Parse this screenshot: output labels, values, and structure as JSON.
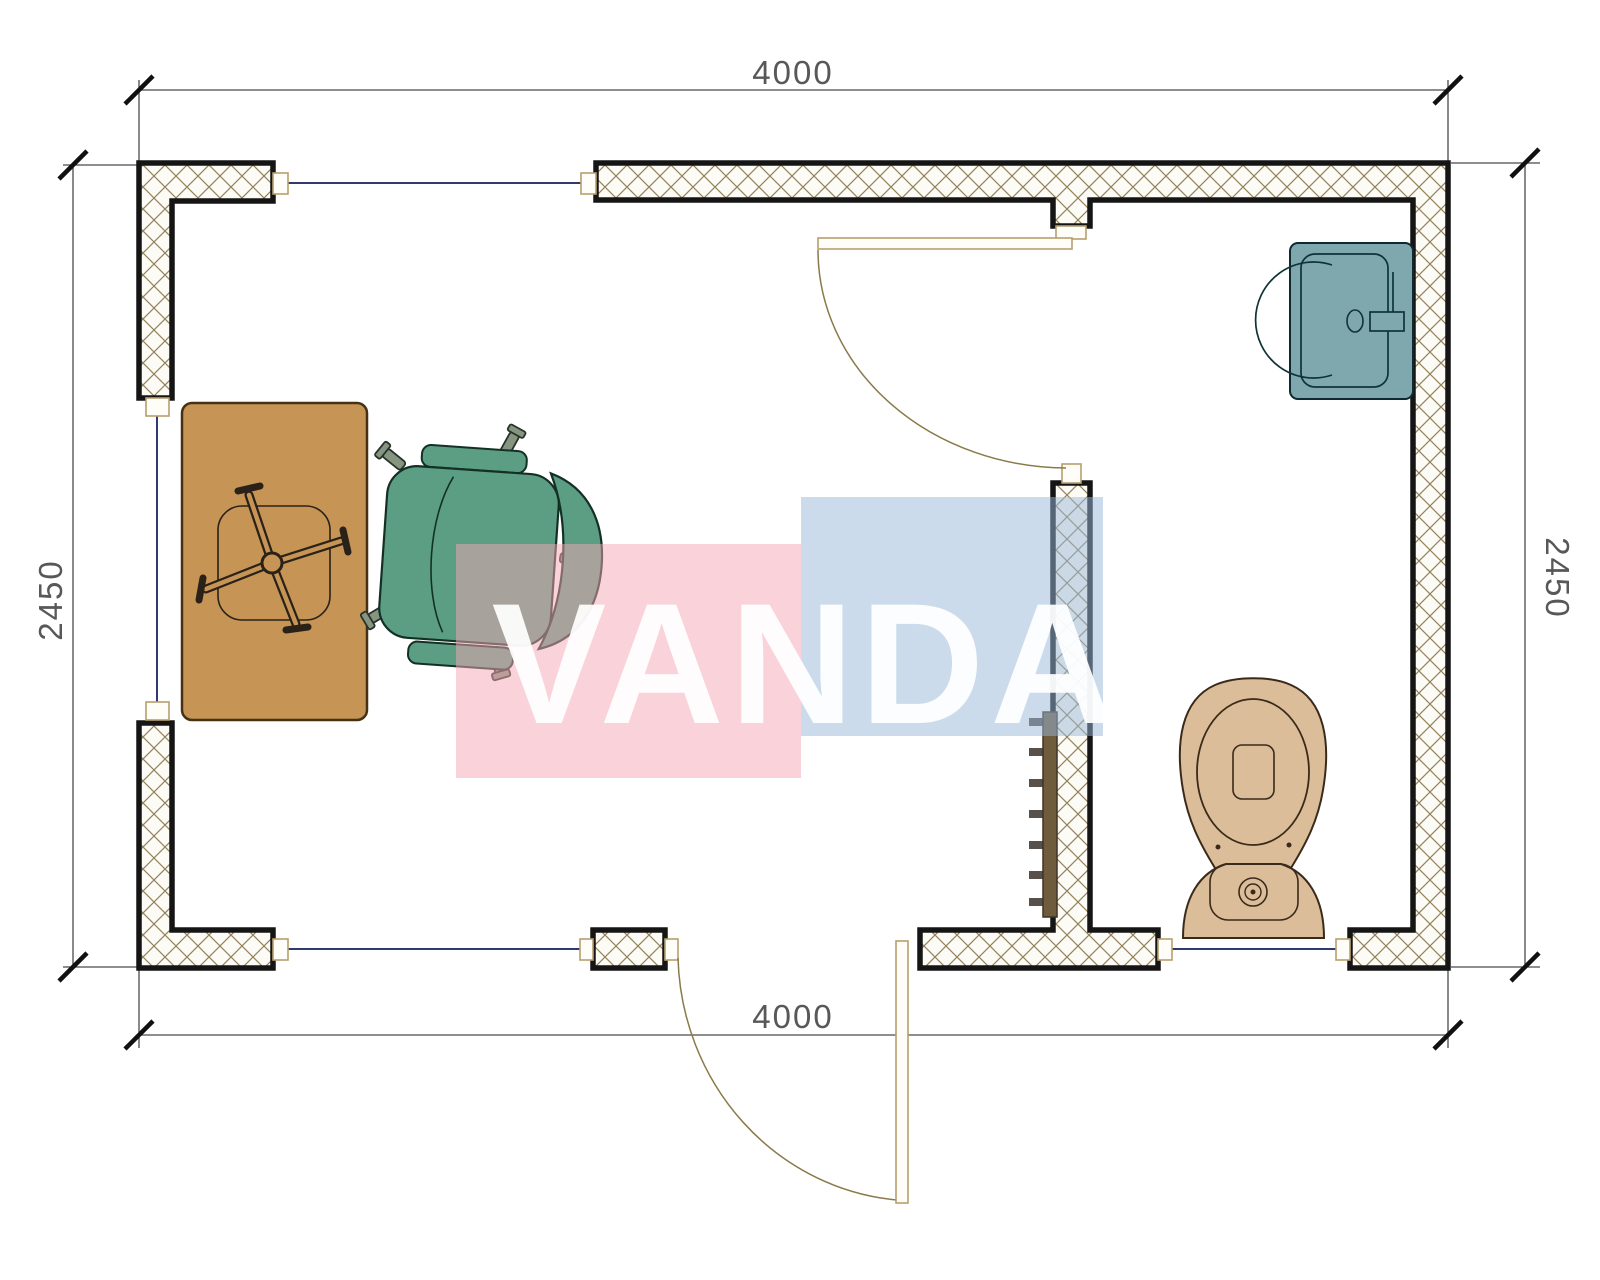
{
  "drawing": {
    "type": "floor-plan",
    "dims": {
      "top": "4000",
      "bottom": "4000",
      "left": "2450",
      "right": "2450"
    },
    "watermark": {
      "text": "VANDA",
      "pink_color": "#f4a6b5",
      "blue_color": "#9ab7da"
    },
    "colors": {
      "wall_outline": "#151515",
      "hatch": "#93825c",
      "window_glazing": "#2f3a6e",
      "frame_beige": "#b89f6e",
      "desk": "#c69455",
      "chair": "#5b9e83",
      "sink": "#7fa8ae",
      "toilet": "#dcbd99",
      "radiator": "#6f5c3d"
    },
    "fixtures": {
      "desk": "desk",
      "office_chair": "office-chair",
      "tucked_chair": "chair-under-desk",
      "sink": "wash-basin",
      "toilet": "toilet",
      "radiator": "radiator",
      "interior_door": "interior-door",
      "exterior_door": "exterior-door"
    }
  }
}
